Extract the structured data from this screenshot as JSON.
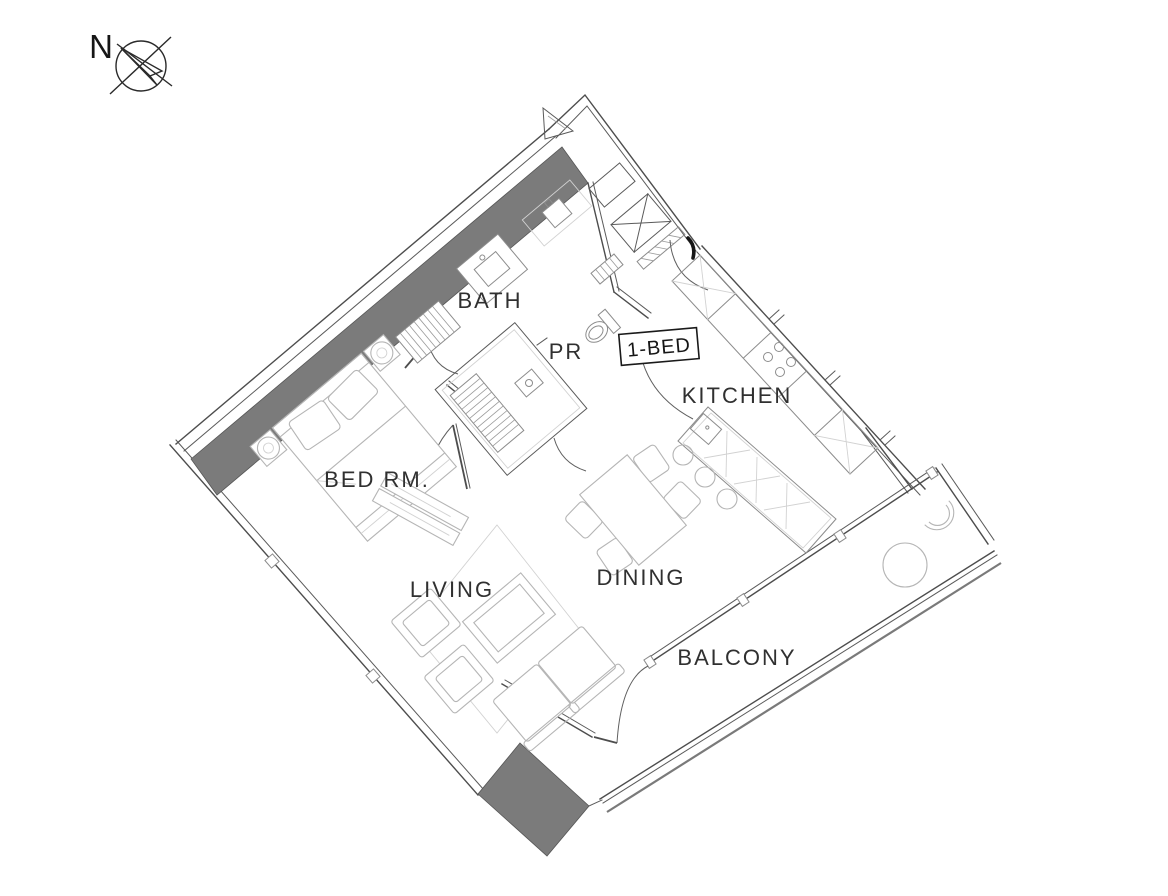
{
  "page": {
    "background": "#ffffff",
    "drawing_type": "apartment floor plan"
  },
  "compass": {
    "label": "N"
  },
  "unit_tag": {
    "label": "1-BED"
  },
  "room_labels": {
    "bath": "BATH",
    "powder_room": "PR",
    "kitchen": "KITCHEN",
    "bedroom": "BED RM.",
    "living": "LIVING",
    "dining": "DINING",
    "balcony": "BALCONY"
  },
  "colors": {
    "background": "#ffffff",
    "wall_line": "#4d4d4d",
    "party_wall_fill": "#7b7b7b",
    "column_fill": "#7d7d7d",
    "furniture_line": "#b5b5b5",
    "fixture_line": "#8c8c8c",
    "label_text": "#303030",
    "unit_tag_border": "#1a1a1a"
  }
}
